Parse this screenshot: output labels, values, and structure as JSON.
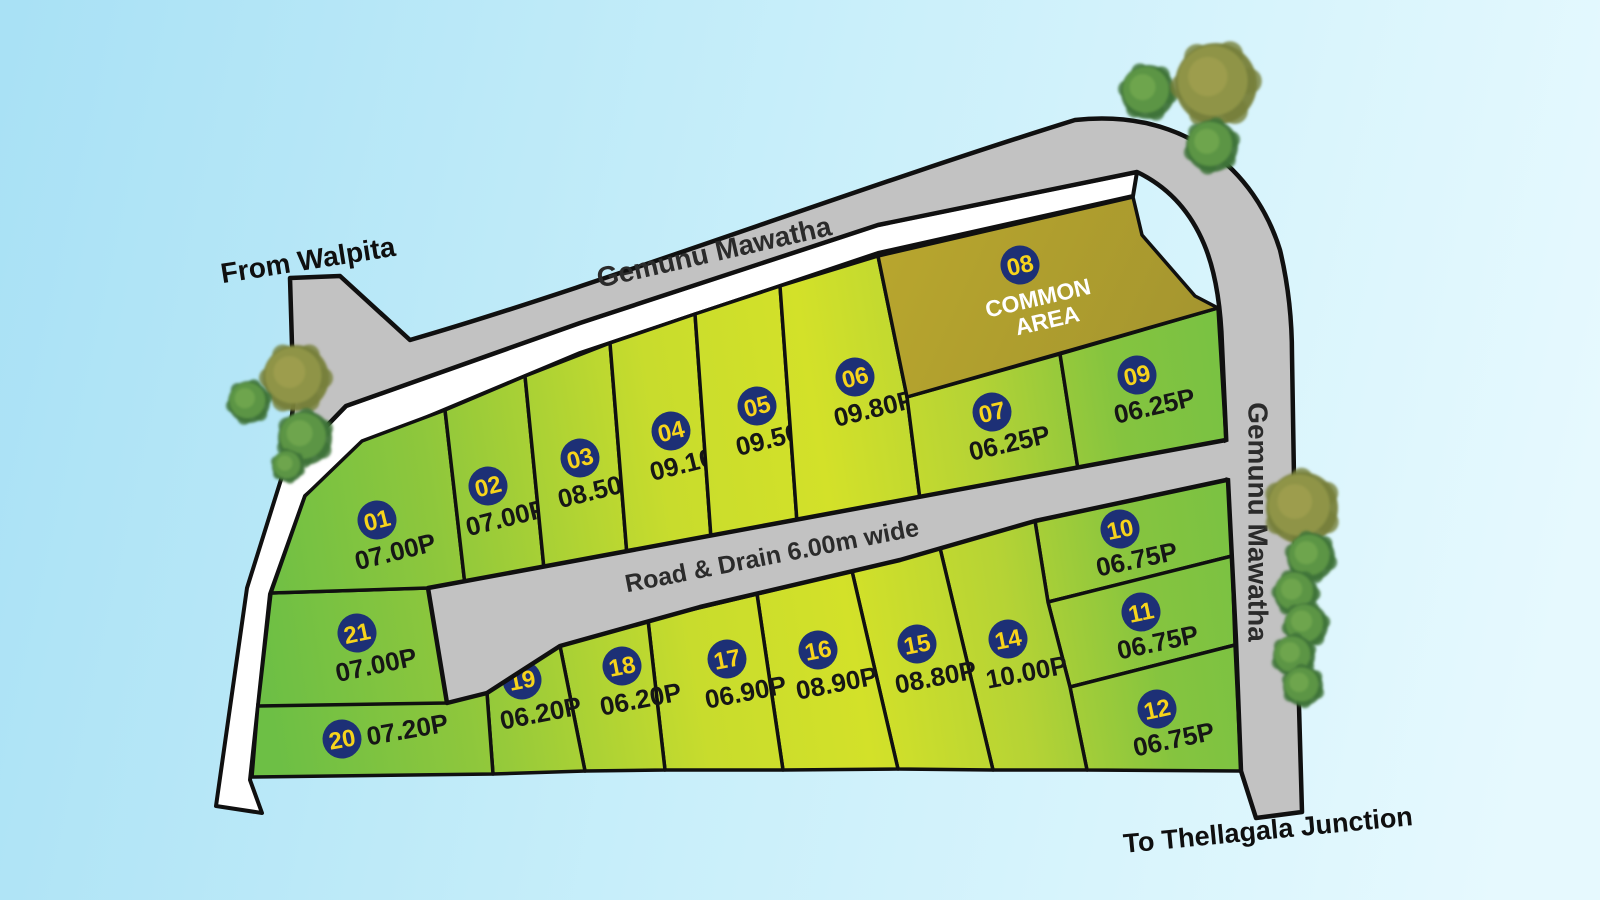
{
  "labels": {
    "from_road": "From Walpita",
    "top_road": "Gemunu Mawatha",
    "right_road": "Gemunu Mawatha",
    "inner_road": "Road & Drain 6.00m wide",
    "to_road": "To Thellagala Junction"
  },
  "common_area": {
    "number": "08",
    "name_line1": "COMMON",
    "name_line2": "AREA"
  },
  "plots": [
    {
      "number": "01",
      "size": "07.00P"
    },
    {
      "number": "02",
      "size": "07.00P"
    },
    {
      "number": "03",
      "size": "08.50P"
    },
    {
      "number": "04",
      "size": "09.10P"
    },
    {
      "number": "05",
      "size": "09.50P"
    },
    {
      "number": "06",
      "size": "09.80P"
    },
    {
      "number": "07",
      "size": "06.25P"
    },
    {
      "number": "09",
      "size": "06.25P"
    },
    {
      "number": "10",
      "size": "06.75P"
    },
    {
      "number": "11",
      "size": "06.75P"
    },
    {
      "number": "12",
      "size": "06.75P"
    },
    {
      "number": "14",
      "size": "10.00P"
    },
    {
      "number": "15",
      "size": "08.80P"
    },
    {
      "number": "16",
      "size": "08.90P"
    },
    {
      "number": "17",
      "size": "06.90P"
    },
    {
      "number": "18",
      "size": "06.20P"
    },
    {
      "number": "19",
      "size": "06.20P"
    },
    {
      "number": "20",
      "size": "07.20P"
    },
    {
      "number": "21",
      "size": "07.00P"
    }
  ],
  "colors": {
    "sky_left": "#a9e1f5",
    "sky_mid": "#c9effa",
    "sky_right": "#e6f9fe",
    "road": "#c2c2c2",
    "outline": "#101010",
    "strip": "#ffffff",
    "land_green_dark": "#6dbf45",
    "land_yellow_green": "#d3e129",
    "common_area": "#b2a02f",
    "circle_fill": "#1d3076",
    "circle_number": "#f7d41b",
    "size_text": "#161616",
    "road_text": "#2b2b2b",
    "outside_text": "#0f0f0f",
    "common_text": "#ffffff"
  }
}
